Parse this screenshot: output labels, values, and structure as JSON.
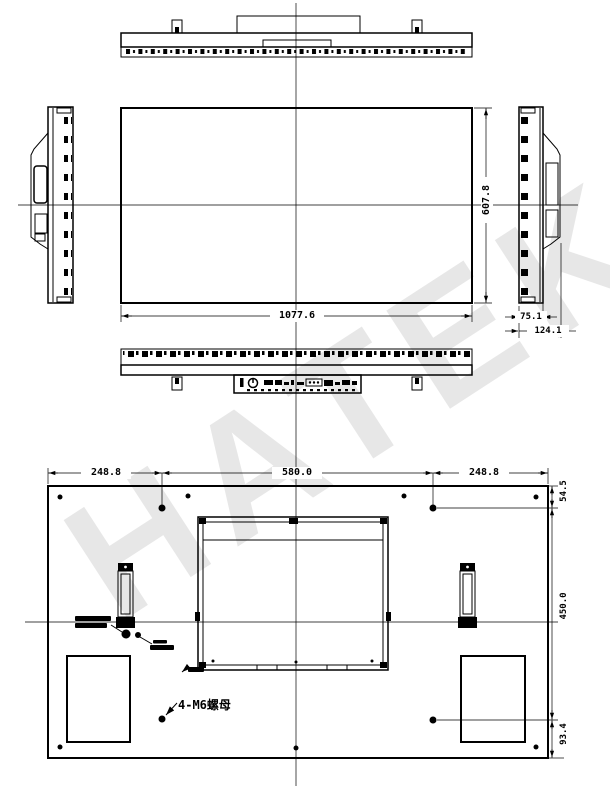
{
  "watermark": "HATEK",
  "drawing": {
    "type": "engineering-drawing",
    "views": [
      "top-view",
      "front-view",
      "left-side-view",
      "right-side-view",
      "bottom-view",
      "rear-view"
    ]
  },
  "dims": {
    "front_width": "1077.6",
    "front_height": "607.8",
    "side_depth": "75.1",
    "side_total_depth": "124.1",
    "rear_left_offset": "248.8",
    "rear_hole_span_h": "580.0",
    "rear_right_offset": "248.8",
    "rear_top_offset": "54.5",
    "rear_hole_span_v": "450.0",
    "rear_bottom_offset": "93.4"
  },
  "labels": {
    "mount_note": "4-M6螺母"
  }
}
